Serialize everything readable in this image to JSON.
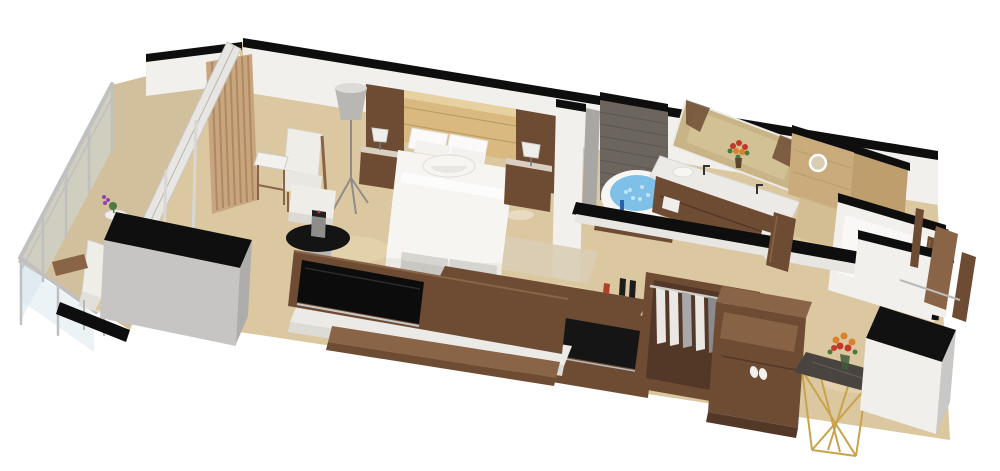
{
  "scene": {
    "type": "isometric-3d-floor-plan",
    "rooms": [
      "balcony",
      "bedroom",
      "bathroom",
      "shower-room",
      "toilet-room",
      "walk-in-closet",
      "entry-corridor"
    ],
    "objects": [
      "glass-railing",
      "balcony-chair",
      "balcony-plant-table",
      "curtain-panel",
      "glass-partition-beam",
      "lounge-chair",
      "ottoman",
      "side-table",
      "floor-lamp",
      "headboard-wall",
      "king-bed",
      "bolster-pillow",
      "nightstand-left",
      "nightstand-right",
      "table-lamp",
      "foot-bench",
      "rug",
      "coffee-table",
      "coffee-machine",
      "minibar-counter",
      "tv-media-wall",
      "tv-screen",
      "stone-ledge",
      "writing-shelf",
      "wine-bottles",
      "storage-cabinet",
      "stone-accent-wall",
      "jacuzzi-tub",
      "double-vanity",
      "vanity-mirror",
      "flower-vase",
      "round-mirror",
      "wardrobe",
      "hanging-shirts",
      "slippers",
      "console-table",
      "entry-cabinet",
      "entry-door"
    ]
  },
  "palette": {
    "floor": "#dcc8a0",
    "floorLight": "#ead9b6",
    "balconyFloor": "#d2bf9b",
    "wallWhite": "#f2f0ed",
    "wallShade": "#e8e6e2",
    "wallCap": "#0e0e0e",
    "wood": "#6e4c34",
    "woodDark": "#533827",
    "woodLight": "#8a6446",
    "headboard": "#d9b97f",
    "headboardLight": "#e7d1a0",
    "stone": "#6b655e",
    "stoneDark": "#544f49",
    "marble": "#c9ab7c",
    "marbleShade": "#bd9e6c",
    "water": "#7fc0e8",
    "waterLight": "#c2e4f6",
    "tub": "#f7f6f3",
    "counter": "#eceae6",
    "grayCabinet": "#c6c5c3",
    "graySide": "#aeadab",
    "curtain": "#c8a57e",
    "curtainDark": "#ad8a62",
    "chair": "#efede8",
    "bench": "#c9c7c2",
    "rug": "#d9cdb5",
    "mirror": "#c9b488",
    "gold": "#c9a24b",
    "consoleTop": "#4a4440",
    "shirtLight": "#e9e8e5",
    "shirtGray": "#a8a7a9",
    "rail": "#c0c0c0",
    "glass": "#cfe0ea",
    "black": "#101010",
    "lampShade": "#b9b7b4",
    "flowerRed": "#c0392b",
    "flowerOrange": "#d9822b",
    "leafGreen": "#4c7a3d"
  }
}
